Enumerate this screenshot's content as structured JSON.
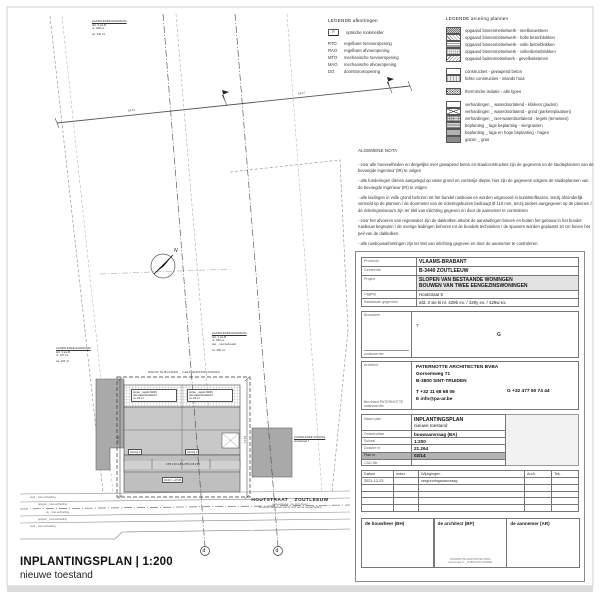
{
  "sheet": {
    "title": "INPLANTINGSPLAN | 1:200",
    "subtitle": "nieuwe toestand"
  },
  "legend_abbrev": {
    "title": "LEGENDE  afkortingen",
    "smoke_icon": "R",
    "smoke_label": "optische rookmelder",
    "items": [
      {
        "abbr": "RTO",
        "label": "regelbare toevoeropening"
      },
      {
        "abbr": "RAO",
        "label": "regelbare afvoeropening"
      },
      {
        "abbr": "MTO",
        "label": "mechanische toevoeropening"
      },
      {
        "abbr": "MAO",
        "label": "mechanische afvoeropening"
      },
      {
        "abbr": "DO",
        "label": "doorstroomopening"
      }
    ]
  },
  "legend_hatch": {
    "title": "LEGENDE  arcering plannen",
    "group1": [
      {
        "label": "opgaand binnenmetselwerk - snelbouwsteen",
        "swatch": "dense-diagonal-hatch"
      },
      {
        "label": "opgaand binnenmetselwerk - holle betonblokken",
        "swatch": "open-diagonal-hatch"
      },
      {
        "label": "opgaand binnenmetselwerk - volle betonblokken",
        "swatch": "horizontal-lines"
      },
      {
        "label": "opgaand binnenmetselwerk - cellenbetonblokken",
        "swatch": "light-grid"
      },
      {
        "label": "opgaand buitenmetselwerk - gevelbakstenen",
        "swatch": "reverse-diagonal-hatch"
      }
    ],
    "group2": [
      {
        "label": "constructies - gewapend beton",
        "swatch": "white"
      },
      {
        "label": "lichte constructies - inlands hout",
        "swatch": "wood"
      }
    ],
    "group3": [
      {
        "label": "thermische isolatie - alle types",
        "swatch": "cross-hatch"
      }
    ],
    "group4": [
      {
        "label": "verhardingen _ waterdoorlatend - klinkers (paden)",
        "swatch": "white"
      },
      {
        "label": "verhardingen _ waterdoorlatend - grind (parkeerplaatsen)",
        "swatch": "crossed-box"
      },
      {
        "label": "verhardingen _ niet-waterdoorlatend - tegels (terrassen)",
        "swatch": "grid"
      },
      {
        "label": "beplanting _ lage beplanting - siergrassen",
        "swatch": "stripes"
      },
      {
        "label": "beplanting _ lage en hoge beplanting - hagen",
        "swatch": "gray-mid"
      },
      {
        "label": "gazon _ gras",
        "swatch": "gray-dark"
      }
    ]
  },
  "nota": {
    "title": "ALGEMENE NOTA",
    "p1": "- voor alle hoeveelheden en dergelijke over gewapend beton en staalconstructies zijn de gegevens en de studieplannen van de bevoegde ingenieur (IR) te volgen",
    "p2": "- alle funderingen dienen aangelegd op vaste grond en vorstvrije diepte, hier zijn de gegevens volgens de studieplannen van de bevoegde ingenieur (IR) te volgen",
    "p3": "- alle leidingen in volle grond behoren tot het bundel ruwbouw en worden uitgevoerd in kunststofbuizen, tenzij afzonderlijk vermeld op de plannen / de doormeter van de rioleringsbuizen bedraagt Ø 110 mm, tenzij anders aangegeven op de plannen / de rioleringsniveau's zijn ter titel van inlichting gegeven en door de aannemer te controleren",
    "p4": "- voor het afvoeren van regenwater zijn de dakkolken alsook de aansluitingen binnen en buiten het gebouw in het bundel ruwbouw begrepen / de overige leidingen behoren tot de bundels technieken / de spuwers worden geplaatst 10 cm boven het peil van de dakkolken.",
    "p5": "- alle ruwbouwafmetingen zijn ter titel van inlichting gegeven en door de aannemer te controleren."
  },
  "titleblock": {
    "provincie_label": "Provincie",
    "provincie": "VLAAMS-BRABANT",
    "gemeente_label": "Gemeente",
    "gemeente": "B-3440    ZOUTLEEUW",
    "project_label": "Project",
    "project1": "SLOPEN VAN BESTAANDE WONINGEN",
    "project2": "BOUWEN VAN TWEE EENGEZINSWONINGEN",
    "ligging_label": "Ligging",
    "ligging": "Houtstraat 5",
    "kadaster_label": "Kadastrale gegevens",
    "kadaster": "afd. 3     sie B     nr. 429b ex. / 429y ex. / 429w ex.",
    "bouwheer_label": "Bouwheer",
    "bouwheer_sublabel": "zaakvoerder",
    "bouwheer_t": "T",
    "bouwheer_g": "G",
    "architect_label": "Architect",
    "architect_person": "Bernhard PATERNOTTE",
    "architect_person_role": "zaakvoerder",
    "architect_name": "PATERNOTTE ARCHITECTEN BVBA",
    "architect_street": "Gorsemweg 71",
    "architect_city": "B-3800    SINT-TRUIDEN",
    "architect_tel": "T    +32 11 68 68 06",
    "architect_email": "E    info@pa-ar.be",
    "architect_gsm": "G    +32 477 50 74 44",
    "naamplan_label": "Naam plan",
    "naamplan": "INPLANTINGSPLAN",
    "naamplan_sub": "nieuwe toestand",
    "meta": [
      {
        "label": "Ontwerpfase",
        "value": "bouwaanvraag (BA)"
      },
      {
        "label": "Schaal",
        "value": "1:200"
      },
      {
        "label": "Dossier nr",
        "value": "21.264"
      },
      {
        "label": "Plan nr",
        "value": "02/14"
      },
      {
        "label": "CAD-file",
        "value": ""
      }
    ],
    "rev_headers": {
      "datum": "Datum",
      "index": "Index",
      "wijzigingen": "Wijzigingen",
      "arch": "Arch.",
      "tek": "Tek."
    },
    "rev_row1": {
      "datum": "2021-12-23",
      "wijzigingen": "vergunningsaanvraag"
    },
    "sig_bouwheer": "de bouwheer (BH)",
    "sig_architect": "de architect (BP)",
    "sig_aannemer": "de aannemer (AR)",
    "stamp1": "PATERNOTTE ARCHITECTEN BVBA",
    "stamp2": "Gorsemweg 71 _ B-3800 SINT-TRUIDEN"
  },
  "plan": {
    "north": "N",
    "street_name": "HOUTSTRAAT _ ZOUTLEEUW",
    "street_sub1": "gemeenteweg _ ca. 10 m breed",
    "street_sub2": "de rooilijn valt samen met de rand van de wegverharding",
    "street_line1": "rand _ kws-verharding",
    "street_line2": "greppel _ kws-verharding",
    "street_line3": "as _ kws-verharding",
    "street_line4": "greppel _ kws-verharding",
    "street_line5": "rand _ kws-verharding",
    "parcel_top": {
      "l1": "AANPALENDE EIGENDOM",
      "l2": "afd. 3   sie B",
      "l3": "nr. 428 ex.",
      "l4": "ca. 440 m²"
    },
    "parcel_left": {
      "l1": "AANPALENDE EIGENDOM",
      "l2": "afd. 3   sie B",
      "l3": "nr. 427 ex.",
      "l4": "ca. 425 m²"
    },
    "parcel_right": {
      "l1": "AANPALENDE EIGENDOM",
      "l2": "afd. 3   sie B",
      "l3": "nr. 430 ex.",
      "l4": "wei _ niet bebouwd",
      "l5": "ca. 460 m²"
    },
    "parcel_house": {
      "l1": "AANPALENDE WONING",
      "l2": "Houtstraat 7"
    },
    "build_label": "NIEUW TE BOUWEN _ 2 EENGEZINSWONINGEN",
    "terras1": {
      "l1": "terras _ tegels 60/60",
      "l2": "niet-waterdoorlatend",
      "l3": "ca. 25 m²"
    },
    "terras2": {
      "l1": "terras _ tegels 60/60",
      "l2": "niet-waterdoorlatend",
      "l3": "ca. 25 m²"
    },
    "woning1": "woning 1",
    "woning2": "woning 2",
    "dims_front": "2.85   3.15   2.85        2.85   3.15   2.85",
    "peil": "±0.00 = +37.25",
    "dim_left": "17.63",
    "dim_right": "17.63",
    "dim_rear1": "16.51",
    "dim_rear2": "16.57",
    "marker_d1": "d",
    "marker_d2": "d"
  }
}
